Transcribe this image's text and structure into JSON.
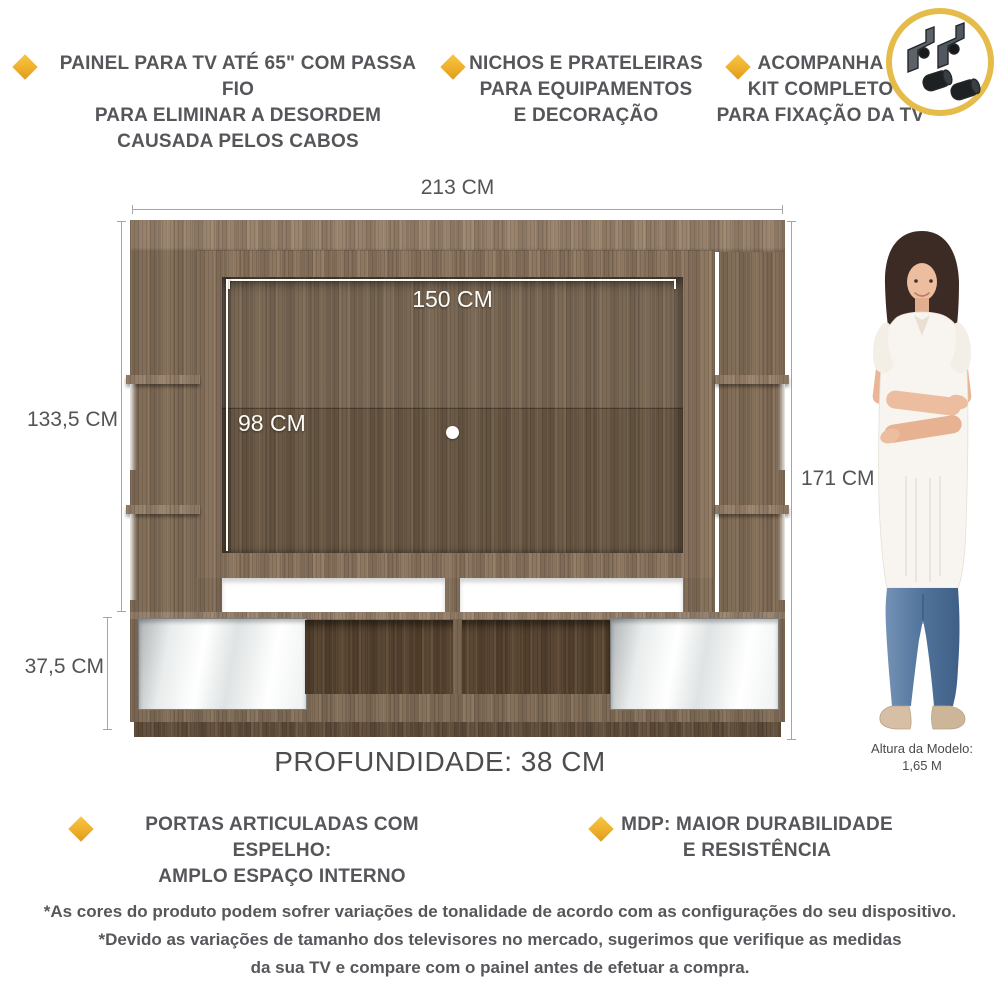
{
  "colors": {
    "accent_gold": "#eeb02c",
    "badge_ring": "#e5bb4a",
    "feature_text_gray": "#55565a",
    "dimension_text_gray": "#545456",
    "dimension_line_gray": "#a5a5a5",
    "wood_base": "#84705a",
    "wood_panel_dark": "#73604b",
    "mirror_white": "#ffffff",
    "denim_blue": "#51739b",
    "measure_line_white": "#fdfcf6"
  },
  "features_top": [
    {
      "icon": "diamond-bullet-icon",
      "lines": [
        "PAINEL PARA TV ATÉ 65\" COM PASSA FIO",
        "PARA ELIMINAR A DESORDEM",
        "CAUSADA PELOS CABOS"
      ]
    },
    {
      "icon": "diamond-bullet-icon",
      "lines": [
        "NICHOS E PRATELEIRAS",
        "PARA EQUIPAMENTOS",
        "E DECORAÇÃO"
      ]
    },
    {
      "icon": "diamond-bullet-icon",
      "lines": [
        "ACOMPANHA",
        "KIT COMPLETO",
        "PARA FIXAÇÃO DA TV"
      ]
    }
  ],
  "kit_badge": {
    "icon": "tv-mount-kit-icon"
  },
  "dimensions": {
    "overall_width": "213 CM",
    "panel_inner_width": "150 CM",
    "panel_side_height": "133,5 CM",
    "panel_inner_height": "98 CM",
    "overall_height": "171 CM",
    "base_height": "37,5 CM",
    "depth": "PROFUNDIDADE: 38 CM"
  },
  "model": {
    "caption": [
      "Altura da Modelo:",
      "1,65 M"
    ]
  },
  "features_bottom": [
    {
      "icon": "diamond-bullet-icon",
      "lines": [
        "PORTAS ARTICULADAS COM ESPELHO:",
        "AMPLO ESPAÇO INTERNO"
      ]
    },
    {
      "icon": "diamond-bullet-icon",
      "lines": [
        "MDP: MAIOR DURABILIDADE",
        "E RESISTÊNCIA"
      ]
    }
  ],
  "disclaimer": [
    "*As cores do produto podem sofrer variações de tonalidade de acordo com as configurações do seu dispositivo.",
    "*Devido as variações de tamanho dos televisores no mercado, sugerimos que verifique as medidas",
    "da sua TV e compare com o painel antes de efetuar a compra."
  ]
}
